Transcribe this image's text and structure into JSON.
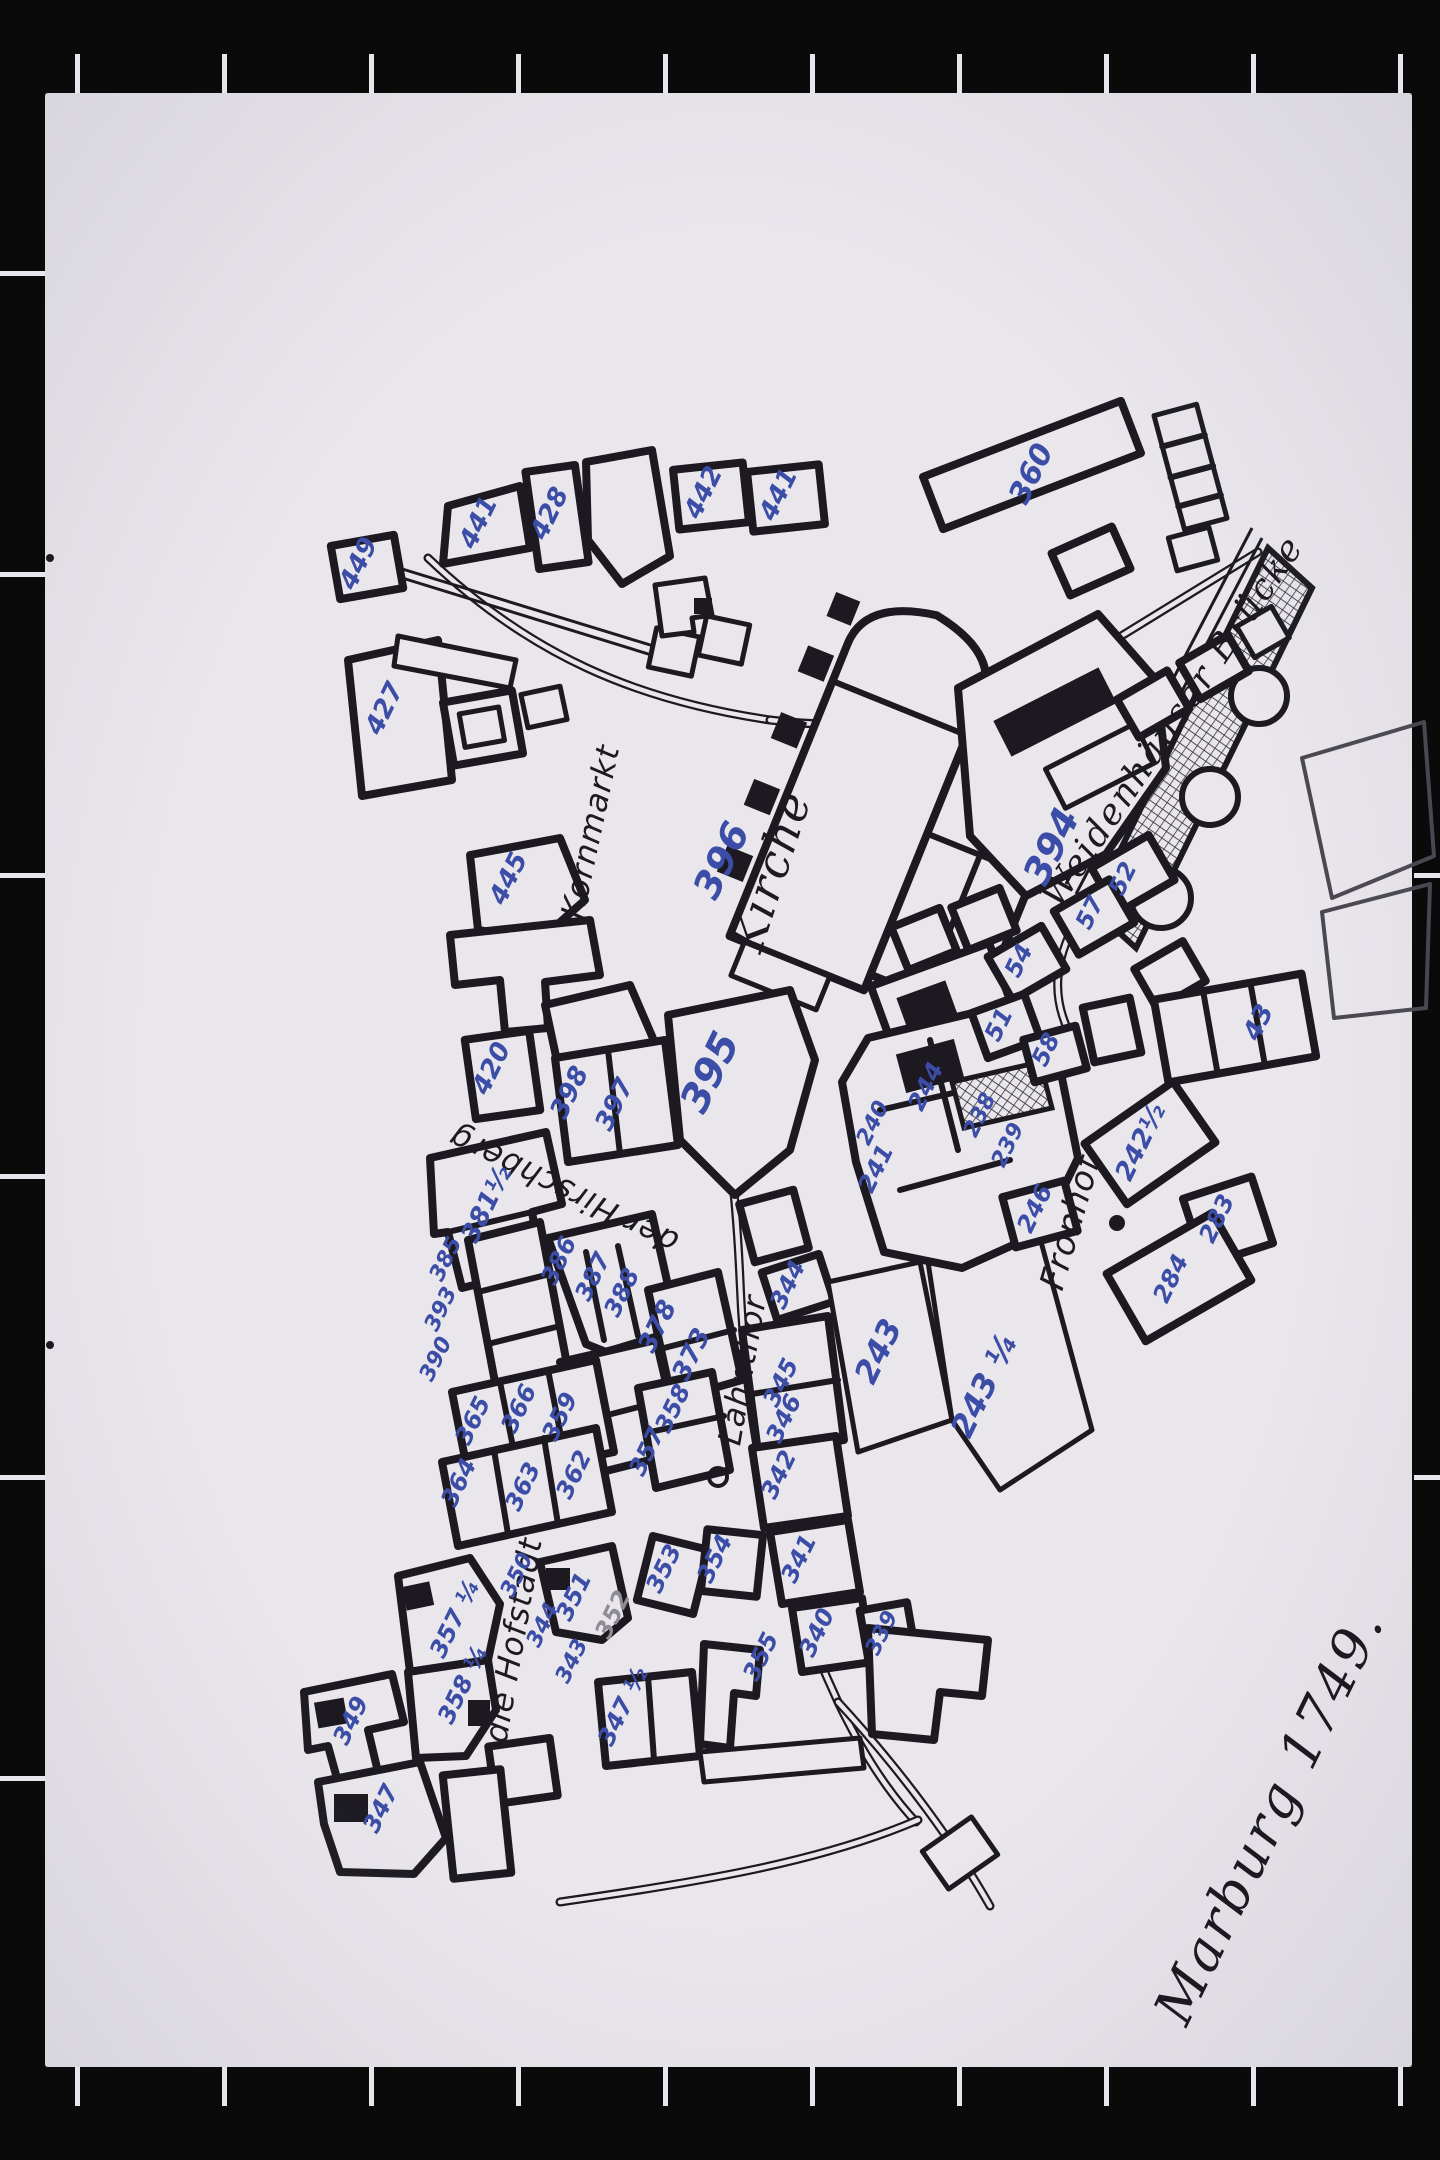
{
  "colors": {
    "background": "#0a0a0b",
    "paper": "#e9e7ec",
    "ink": "#1c1a20",
    "number_blue": "#3b4da6",
    "pencil": "#8f8c96"
  },
  "map": {
    "title": {
      "t": "Marburg 1749.",
      "x": 1286,
      "y": 1824,
      "r": -64,
      "s": 54
    },
    "labels": [
      {
        "t": "Kirche",
        "x": 786,
        "y": 876,
        "r": -72,
        "s": 46,
        "cur": true
      },
      {
        "t": "Kornmarkt",
        "x": 601,
        "y": 834,
        "r": -78,
        "s": 32
      },
      {
        "t": "der Hirschberg",
        "x": 568,
        "y": 1180,
        "r": -154,
        "s": 32
      },
      {
        "t": "Lahnthor",
        "x": 753,
        "y": 1372,
        "r": -80,
        "s": 32
      },
      {
        "t": "Fronhof",
        "x": 1081,
        "y": 1226,
        "r": -74,
        "s": 34
      },
      {
        "t": "Weidenhäuser Brücke",
        "x": 1182,
        "y": 728,
        "r": -56,
        "s": 36,
        "cur": true
      },
      {
        "t": "die Hofstadt",
        "x": 524,
        "y": 1642,
        "r": -80,
        "s": 32
      }
    ],
    "house_numbers": [
      {
        "t": "449",
        "x": 366,
        "y": 567
      },
      {
        "t": "441",
        "x": 486,
        "y": 526
      },
      {
        "t": "428",
        "x": 557,
        "y": 517
      },
      {
        "t": "442",
        "x": 711,
        "y": 496
      },
      {
        "t": "441",
        "x": 786,
        "y": 498
      },
      {
        "t": "427",
        "x": 392,
        "y": 712
      },
      {
        "t": "360",
        "x": 1040,
        "y": 478,
        "s": 30
      },
      {
        "t": "396",
        "x": 733,
        "y": 866,
        "s": 38
      },
      {
        "t": "394",
        "x": 1063,
        "y": 852,
        "s": 38
      },
      {
        "t": "445",
        "x": 516,
        "y": 882
      },
      {
        "t": "420",
        "x": 499,
        "y": 1072
      },
      {
        "t": "398",
        "x": 577,
        "y": 1096
      },
      {
        "t": "397",
        "x": 622,
        "y": 1108
      },
      {
        "t": "395",
        "x": 722,
        "y": 1078,
        "s": 40
      },
      {
        "t": "385",
        "x": 452,
        "y": 1262,
        "s": 22
      },
      {
        "t": "393",
        "x": 447,
        "y": 1312,
        "s": 22
      },
      {
        "t": "390",
        "x": 442,
        "y": 1362,
        "s": 22
      },
      {
        "t": "381½",
        "x": 494,
        "y": 1208
      },
      {
        "t": "386",
        "x": 566,
        "y": 1264,
        "s": 24
      },
      {
        "t": "387",
        "x": 600,
        "y": 1280,
        "s": 24
      },
      {
        "t": "388",
        "x": 629,
        "y": 1296,
        "s": 24
      },
      {
        "t": "378",
        "x": 665,
        "y": 1330
      },
      {
        "t": "373",
        "x": 699,
        "y": 1358
      },
      {
        "t": "344",
        "x": 795,
        "y": 1288,
        "s": 24
      },
      {
        "t": "345",
        "x": 788,
        "y": 1386,
        "s": 24
      },
      {
        "t": "346",
        "x": 791,
        "y": 1422,
        "s": 24
      },
      {
        "t": "342",
        "x": 786,
        "y": 1478,
        "s": 24
      },
      {
        "t": "341",
        "x": 806,
        "y": 1562,
        "s": 24
      },
      {
        "t": "340",
        "x": 824,
        "y": 1636,
        "s": 24
      },
      {
        "t": "339",
        "x": 888,
        "y": 1636,
        "s": 22
      },
      {
        "t": "355",
        "x": 768,
        "y": 1660,
        "s": 24
      },
      {
        "t": "243",
        "x": 888,
        "y": 1356,
        "s": 32
      },
      {
        "t": "243 ¼",
        "x": 994,
        "y": 1390,
        "s": 32
      },
      {
        "t": "244",
        "x": 933,
        "y": 1090,
        "s": 24
      },
      {
        "t": "240",
        "x": 879,
        "y": 1126,
        "s": 22
      },
      {
        "t": "241",
        "x": 883,
        "y": 1172,
        "s": 24
      },
      {
        "t": "238",
        "x": 986,
        "y": 1118,
        "s": 22
      },
      {
        "t": "239",
        "x": 1014,
        "y": 1148,
        "s": 22
      },
      {
        "t": "246",
        "x": 1042,
        "y": 1212,
        "s": 24
      },
      {
        "t": "242½",
        "x": 1148,
        "y": 1146
      },
      {
        "t": "283",
        "x": 1224,
        "y": 1222,
        "s": 24
      },
      {
        "t": "284",
        "x": 1178,
        "y": 1282,
        "s": 24
      },
      {
        "t": "52",
        "x": 1130,
        "y": 882,
        "s": 24
      },
      {
        "t": "57",
        "x": 1097,
        "y": 916,
        "s": 24
      },
      {
        "t": "54",
        "x": 1026,
        "y": 964,
        "s": 24
      },
      {
        "t": "51",
        "x": 1006,
        "y": 1028,
        "s": 24
      },
      {
        "t": "58",
        "x": 1053,
        "y": 1053,
        "s": 24
      },
      {
        "t": "43",
        "x": 1266,
        "y": 1026
      },
      {
        "t": "365",
        "x": 480,
        "y": 1424,
        "s": 24
      },
      {
        "t": "366",
        "x": 526,
        "y": 1412,
        "s": 24
      },
      {
        "t": "359",
        "x": 567,
        "y": 1420,
        "s": 24
      },
      {
        "t": "364",
        "x": 466,
        "y": 1486,
        "s": 24
      },
      {
        "t": "363",
        "x": 530,
        "y": 1490,
        "s": 24
      },
      {
        "t": "362",
        "x": 581,
        "y": 1478,
        "s": 24
      },
      {
        "t": "358",
        "x": 680,
        "y": 1412,
        "s": 24
      },
      {
        "t": "357",
        "x": 654,
        "y": 1455,
        "s": 24
      },
      {
        "t": "353",
        "x": 671,
        "y": 1572,
        "s": 24
      },
      {
        "t": "354",
        "x": 722,
        "y": 1562,
        "s": 24
      },
      {
        "t": "357 ¼",
        "x": 462,
        "y": 1622,
        "s": 24
      },
      {
        "t": "358 ¼",
        "x": 470,
        "y": 1688,
        "s": 24
      },
      {
        "t": "350",
        "x": 523,
        "y": 1578,
        "s": 22
      },
      {
        "t": "351",
        "x": 581,
        "y": 1600,
        "s": 24
      },
      {
        "t": "344",
        "x": 549,
        "y": 1628,
        "s": 22
      },
      {
        "t": "343",
        "x": 578,
        "y": 1664,
        "s": 22
      },
      {
        "t": "352",
        "x": 620,
        "y": 1618,
        "s": 24,
        "c": "pencil"
      },
      {
        "t": "347 ½",
        "x": 630,
        "y": 1710,
        "s": 24
      },
      {
        "t": "349",
        "x": 358,
        "y": 1724,
        "s": 24
      },
      {
        "t": "347",
        "x": 388,
        "y": 1812,
        "s": 24
      }
    ]
  }
}
